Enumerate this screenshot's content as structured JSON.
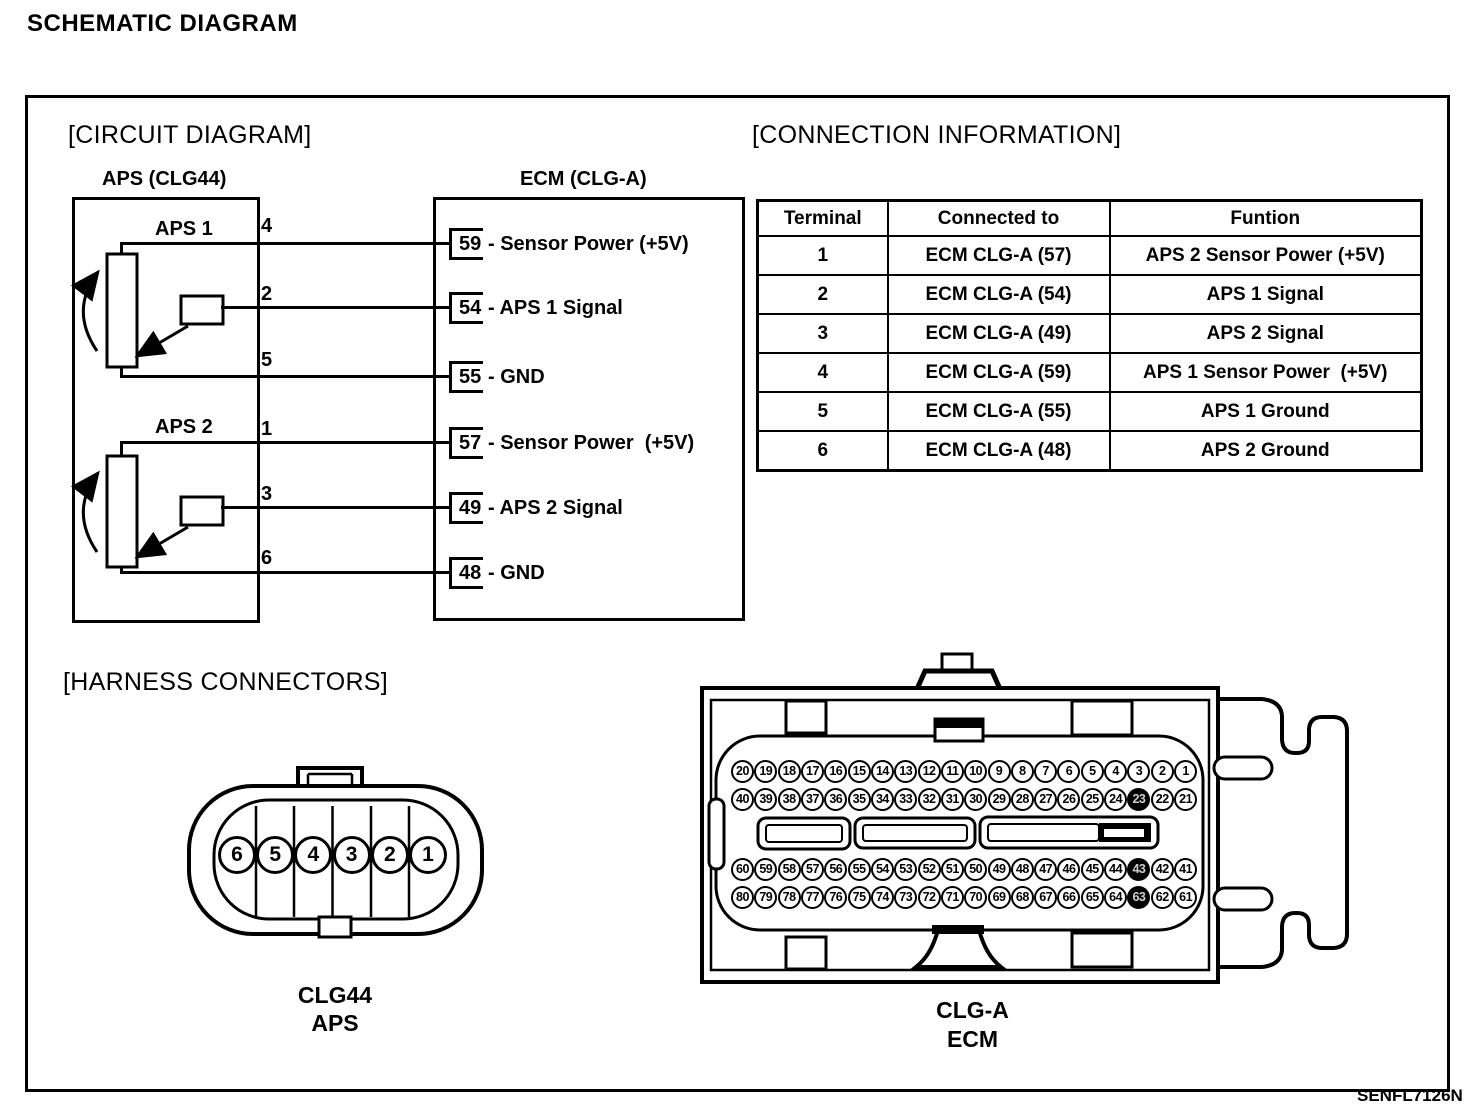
{
  "page": {
    "title": "SCHEMATIC DIAGRAM",
    "figure_code": "SENFL7126N"
  },
  "circuit": {
    "section_title": "[CIRCUIT DIAGRAM]",
    "aps_connector_label": "APS (CLG44)",
    "ecm_connector_label": "ECM (CLG-A)",
    "aps1_label": "APS 1",
    "aps2_label": "APS 2",
    "wires": [
      {
        "aps_pin": "4",
        "ecm_pin": "59",
        "ecm_suffix": "- Sensor Power (+5V)"
      },
      {
        "aps_pin": "2",
        "ecm_pin": "54",
        "ecm_suffix": "- APS 1 Signal"
      },
      {
        "aps_pin": "5",
        "ecm_pin": "55",
        "ecm_suffix": "- GND"
      },
      {
        "aps_pin": "1",
        "ecm_pin": "57",
        "ecm_suffix": "- Sensor Power  (+5V)"
      },
      {
        "aps_pin": "3",
        "ecm_pin": "49",
        "ecm_suffix": "- APS 2 Signal"
      },
      {
        "aps_pin": "6",
        "ecm_pin": "48",
        "ecm_suffix": "- GND"
      }
    ]
  },
  "connection_information": {
    "section_title": "[CONNECTION INFORMATION]",
    "headers": [
      "Terminal",
      "Connected to",
      "Funtion"
    ],
    "rows": [
      [
        "1",
        "ECM CLG-A (57)",
        "APS 2 Sensor Power (+5V)"
      ],
      [
        "2",
        "ECM CLG-A (54)",
        "APS 1 Signal"
      ],
      [
        "3",
        "ECM CLG-A (49)",
        "APS 2 Signal"
      ],
      [
        "4",
        "ECM CLG-A (59)",
        "APS 1 Sensor Power  (+5V)"
      ],
      [
        "5",
        "ECM CLG-A (55)",
        "APS 1 Ground"
      ],
      [
        "6",
        "ECM CLG-A (48)",
        "APS 2 Ground"
      ]
    ]
  },
  "harness_connectors": {
    "section_title": "[HARNESS CONNECTORS]",
    "clg44": {
      "pins": [
        "6",
        "5",
        "4",
        "3",
        "2",
        "1"
      ],
      "name": "CLG44",
      "type": "APS"
    },
    "clga": {
      "name": "CLG-A",
      "type": "ECM",
      "pin_rows": [
        [
          "20",
          "19",
          "18",
          "17",
          "16",
          "15",
          "14",
          "13",
          "12",
          "11",
          "10",
          "9",
          "8",
          "7",
          "6",
          "5",
          "4",
          "3",
          "2",
          "1"
        ],
        [
          "40",
          "39",
          "38",
          "37",
          "36",
          "35",
          "34",
          "33",
          "32",
          "31",
          "30",
          "29",
          "28",
          "27",
          "26",
          "25",
          "24",
          "23",
          "22",
          "21"
        ],
        [
          "60",
          "59",
          "58",
          "57",
          "56",
          "55",
          "54",
          "53",
          "52",
          "51",
          "50",
          "49",
          "48",
          "47",
          "46",
          "45",
          "44",
          "43",
          "42",
          "41"
        ],
        [
          "80",
          "79",
          "78",
          "77",
          "76",
          "75",
          "74",
          "73",
          "72",
          "71",
          "70",
          "69",
          "68",
          "67",
          "66",
          "65",
          "64",
          "63",
          "62",
          "61"
        ]
      ],
      "dark_pins": [
        "23",
        "43",
        "63"
      ]
    }
  }
}
